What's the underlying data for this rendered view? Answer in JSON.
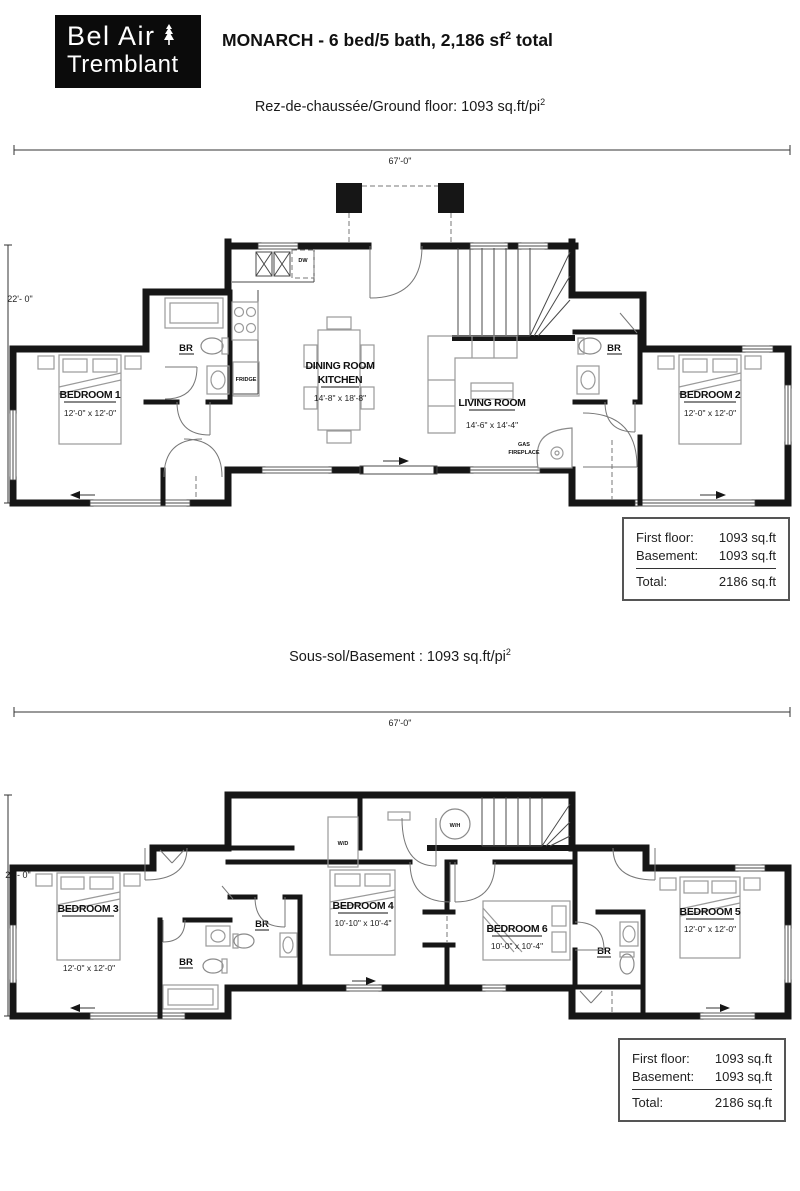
{
  "header": {
    "logo_line1": "Bel Air",
    "logo_line2": "Tremblant",
    "logo_icon": "pine-tree-icon",
    "title_main": "MONARCH - 6 bed/5 bath, 2,186 sf",
    "title_sup": "2",
    "title_tail": " total"
  },
  "ground_floor": {
    "subtitle_main": "Rez-de-chaussée/Ground floor: 1093 sq.ft/pi",
    "subtitle_sup": "2",
    "dim_width": "67'-0\"",
    "dim_height": "22'- 0\"",
    "rooms": {
      "bedroom1": {
        "name": "BEDROOM 1",
        "dims": "12'-0\" x 12'-0\""
      },
      "bedroom2": {
        "name": "BEDROOM 2",
        "dims": "12'-0\" x 12'-0\""
      },
      "dining": {
        "name_line1": "DINING ROOM",
        "name_line2": "KITCHEN",
        "dims": "14'-8\" x 18'-8\""
      },
      "living": {
        "name": "LIVING ROOM",
        "dims": "14'-6\" x 14'-4\""
      }
    },
    "labels": {
      "br_left": "BR",
      "br_right": "BR",
      "fridge": "FRIDGE",
      "dw": "DW",
      "gas_line1": "GAS",
      "gas_line2": "FIREPLACE"
    }
  },
  "basement": {
    "subtitle_main": "Sous-sol/Basement : 1093 sq.ft/pi",
    "subtitle_sup": "2",
    "dim_width": "67'-0\"",
    "dim_height": "22'- 0\"",
    "rooms": {
      "bedroom3": {
        "name": "BEDROOM 3",
        "dims": "12'-0\" x 12'-0\""
      },
      "bedroom4": {
        "name": "BEDROOM 4",
        "dims": "10'-10\" x 10'-4\""
      },
      "bedroom5": {
        "name": "BEDROOM 5",
        "dims": "12'-0\" x 12'-0\""
      },
      "bedroom6": {
        "name": "BEDROOM 6",
        "dims": "10'-0\" x 10'-4\""
      }
    },
    "labels": {
      "br1": "BR",
      "br2": "BR",
      "br3": "BR",
      "wd": "W/D",
      "wh": "W/H"
    }
  },
  "area_table": {
    "row1_label": "First floor:",
    "row1_value": "1093 sq.ft",
    "row2_label": "Basement:",
    "row2_value": "1093 sq.ft",
    "total_label": "Total:",
    "total_value": "2186 sq.ft"
  }
}
